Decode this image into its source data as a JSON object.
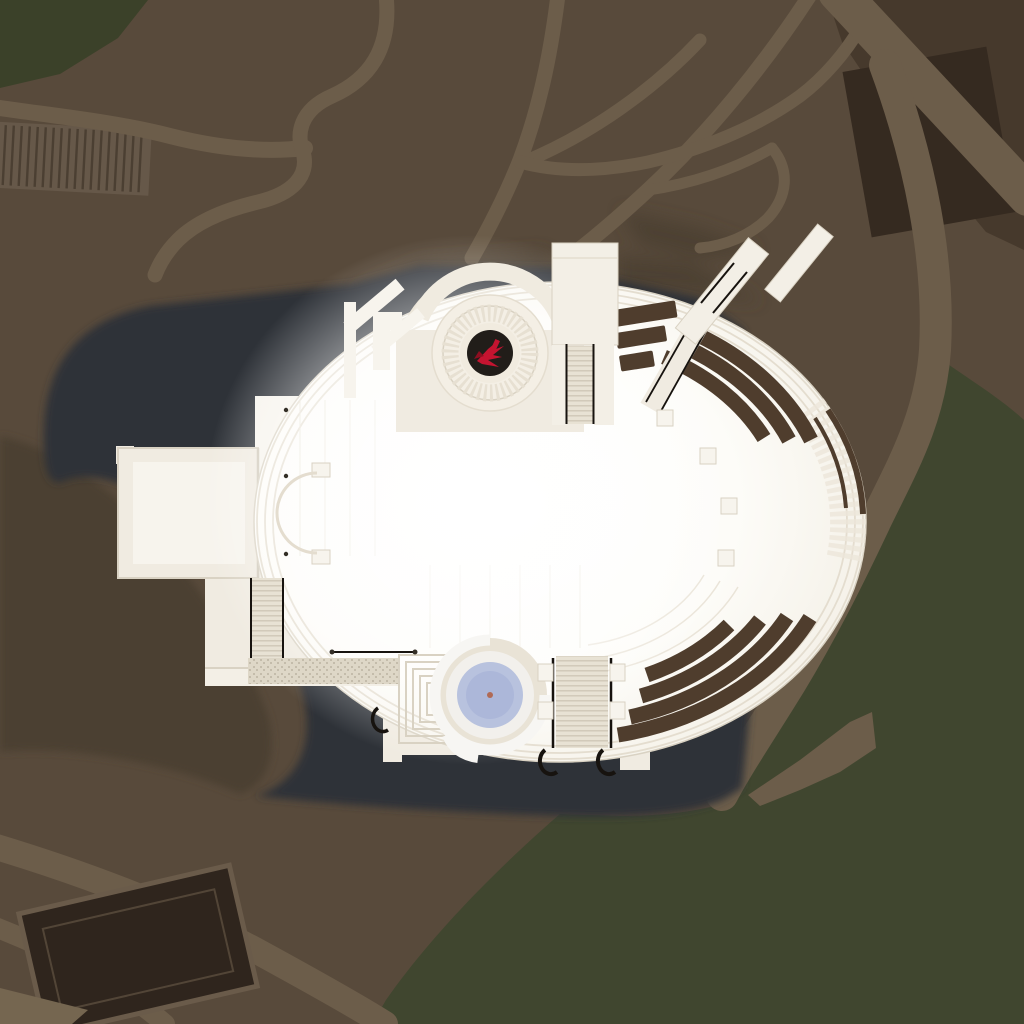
{
  "scene": {
    "view": "aerial-top-down-architectural-render",
    "subject": "oval-concert-hall-complex-with-dome-emblem",
    "emblem_icon": "red-phoenix-emblem",
    "landmarks": [
      "oval-hall-roof",
      "west-wing",
      "north-dome",
      "north-tower",
      "northeast-ramp",
      "planter-arcs",
      "south-plaza",
      "spiral-pool",
      "grand-stairs",
      "cast-shadow",
      "park-paths",
      "lawn",
      "parking-lot"
    ]
  },
  "colors": {
    "terrain": "#584a3b",
    "terrain_shade": "#4c4032",
    "road": "#6c5d4a",
    "dark_zone": "#46392c",
    "dark_block": "#352a20",
    "green_corner": "#3b4129",
    "lawn": "#40462f",
    "shadow": "#2f3338",
    "bank": "#4c4033",
    "parking": "#2f251d",
    "curb": "#6a5b4a",
    "corner_strip": "#756650",
    "rib_strip": "#665849",
    "rib_line": "#4b3f32",
    "cream": "#f0ebe1",
    "cream_bright": "#f7f4ed",
    "white": "#ffffff",
    "tower": "#f3efe6",
    "edge_line": "#d9d2c3",
    "ring_line": "#e4ddcf",
    "faint_line": "#eae4d8",
    "seam": "#d0c9ba",
    "planter": "#4f3d2d",
    "shingle": "#ece6d9",
    "steps_bg": "#e8e2d4",
    "steps_line": "#cfc8b8",
    "gravel_bg": "#ded7c7",
    "gravel_dot": "#c4bcab",
    "railing": "#17130f",
    "dot_dark": "#332e26",
    "dome_ring": "#e7e0d2",
    "dome_face": "#f4efe5",
    "dome_inner": "#f1ebdf",
    "horseshoe_a": "#f0ebe0",
    "horseshoe_b": "#ece6d9",
    "oculus": "#211d19",
    "logo_red": "#c41430",
    "logo_red_dark": "#8d0e20",
    "pool_ring": "#e9e3d6",
    "pool_mid": "#f2f0ec",
    "pool_white": "#f7f6f3",
    "pool_water": "#b8c2de",
    "pool_water_deep": "#a9b5d8",
    "pool_dot": "#b06a55",
    "glow_core": "#ffffff",
    "glow_mid": "#fdfcf8",
    "glow_edge": "#efeade"
  }
}
